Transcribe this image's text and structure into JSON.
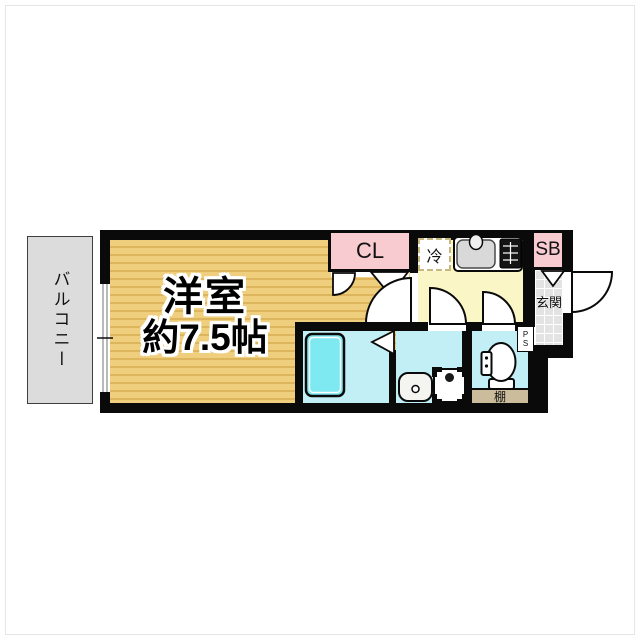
{
  "floorplan": {
    "rooms": {
      "balcony": {
        "label": "バルコニー"
      },
      "main_room": {
        "label_line1": "洋室",
        "label_line2": "約7.5帖"
      },
      "closet": {
        "label": "CL"
      },
      "refrigerator": {
        "label": "冷"
      },
      "shoe_box": {
        "label": "SB"
      },
      "entrance": {
        "label": "玄関"
      },
      "pipe_space": {
        "label_p": "P",
        "label_s": "S"
      },
      "shelf": {
        "label": "棚"
      }
    },
    "colors": {
      "wall": "#0a0a0a",
      "room_floor": "#EFCE7D",
      "room_floor_stripe": "#DCB55C",
      "closet_pink": "#F8CBD0",
      "kitchen_yellow": "#FAF6C5",
      "wet_area_cyan": "#C2EFF5",
      "bathtub_cyan": "#7FE9F2",
      "balcony_gray": "#DCDCDC",
      "entrance_tile": "#E3E3E3",
      "shelf_tan": "#CBBC9B"
    }
  }
}
